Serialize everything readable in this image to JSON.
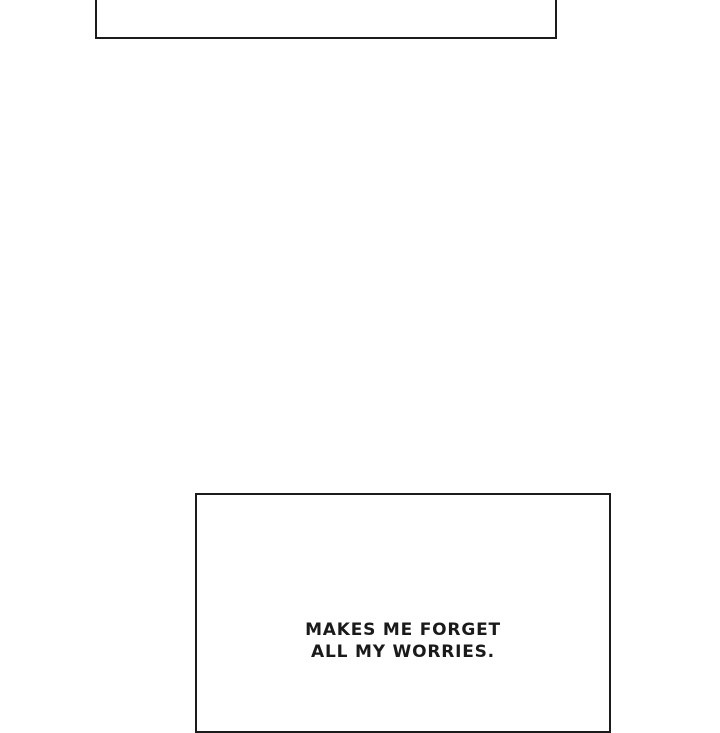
{
  "page": {
    "type": "comic-page-section",
    "background_color": "#ffffff"
  },
  "colors": {
    "panel_border": "#1b1b1b",
    "caption_text": "#1a1a1a",
    "panel_fill": "#ffffff"
  },
  "panels": {
    "top_panel": {
      "content": "",
      "note": "empty panel, cropped at top edge of screenshot"
    },
    "bottom_panel": {
      "note": "panel cropped at bottom edge of screenshot",
      "caption": {
        "line1": "MAKES ME FORGET",
        "line2": "ALL MY WORRIES."
      }
    }
  }
}
